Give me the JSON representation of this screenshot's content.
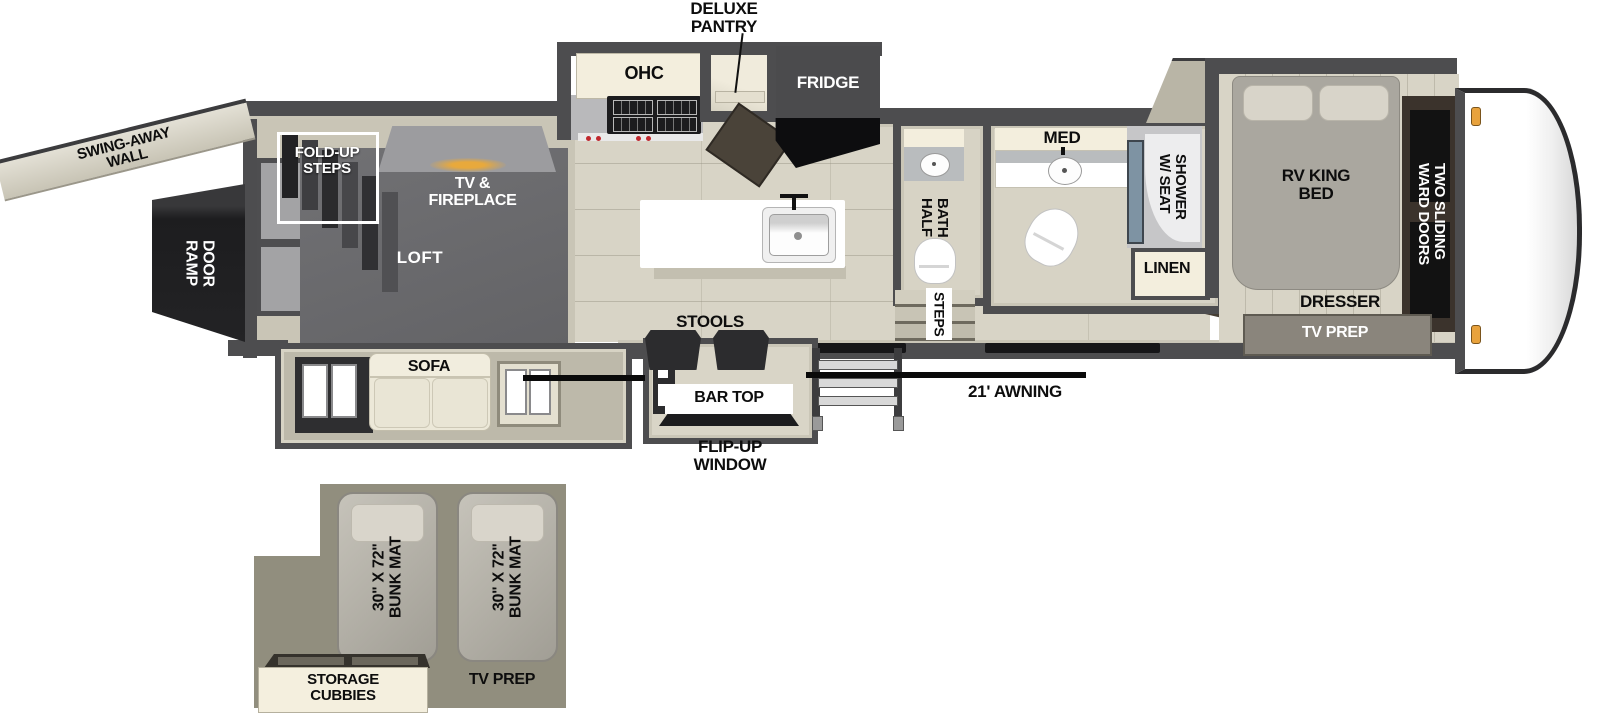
{
  "plan": {
    "rear": {
      "swing_away_wall": "SWING-AWAY\nWALL",
      "ramp_door": "RAMP\nDOOR",
      "fold_up_steps": "FOLD-UP\nSTEPS",
      "tv_fireplace": "TV &\nFIREPLACE",
      "loft": "LOFT",
      "sofa": "SOFA"
    },
    "kitchen": {
      "deluxe_pantry": "DELUXE\nPANTRY",
      "ohc": "OHC",
      "fridge": "FRIDGE",
      "stools": "STOOLS",
      "bar_top": "BAR TOP",
      "flip_up_window": "FLIP-UP\nWINDOW"
    },
    "bath": {
      "med": "MED",
      "half_bath": "HALF\nBATH",
      "shower_w_seat": "SHOWER\nW/ SEAT",
      "linen": "LINEN",
      "steps": "STEPS"
    },
    "bedroom": {
      "rv_king_bed": "RV KING\nBED",
      "two_sliding_ward_doors": "TWO SLIDING\nWARD DOORS",
      "dresser": "DRESSER",
      "tv_prep": "TV PREP"
    },
    "exterior": {
      "awning_21": "21' AWNING"
    },
    "bunk": {
      "bunk_mat_1": "30\" X 72\"\nBUNK MAT",
      "bunk_mat_2": "30\" X 72\"\nBUNK MAT",
      "storage_cubbies": "STORAGE\nCUBBIES",
      "tv_prep": "TV PREP"
    },
    "colors": {
      "wall": "#4d4d4f",
      "floor": "#d8d4c6",
      "loft_carpet": "#69696c",
      "cabinet_cream": "#f3eedd",
      "bunk_floor": "#918e7e",
      "awning_line": "#0a0a0a",
      "marker_light": "#e8a23c",
      "shower_glass": "#7e93a3"
    }
  }
}
